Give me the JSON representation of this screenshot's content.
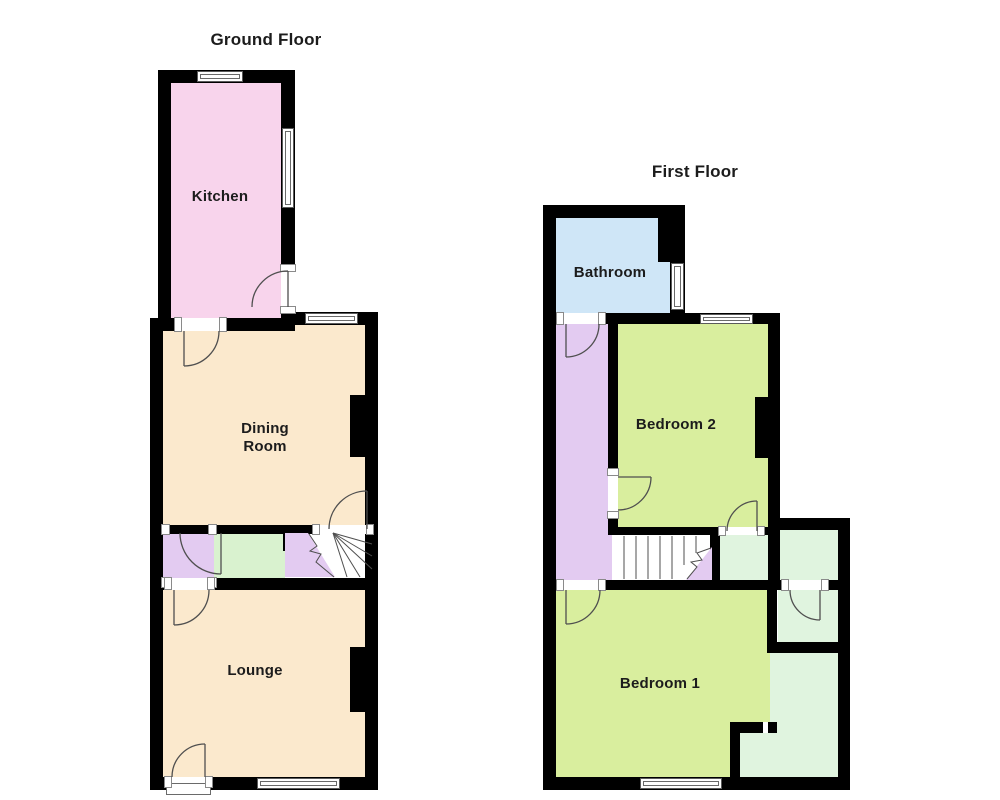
{
  "canvas": {
    "background": "#ffffff"
  },
  "colors": {
    "wall": "#000000",
    "door_line": "#4f4f4f",
    "kitchen": "#f8d4ec",
    "reception": "#fbe9cd",
    "hall_green": "#d9f2cf",
    "purple": "#e3cbf1",
    "bathroom": "#cfe6f7",
    "bedroom": "#d9ee9e",
    "mint": "#e0f4df",
    "stairs": "#ffffff"
  },
  "ground_floor": {
    "title": "Ground Floor",
    "rooms": {
      "kitchen": "Kitchen",
      "dining": "Dining Room",
      "lounge": "Lounge"
    }
  },
  "first_floor": {
    "title": "First Floor",
    "rooms": {
      "bathroom": "Bathroom",
      "bedroom2": "Bedroom 2",
      "bedroom1": "Bedroom 1"
    }
  }
}
